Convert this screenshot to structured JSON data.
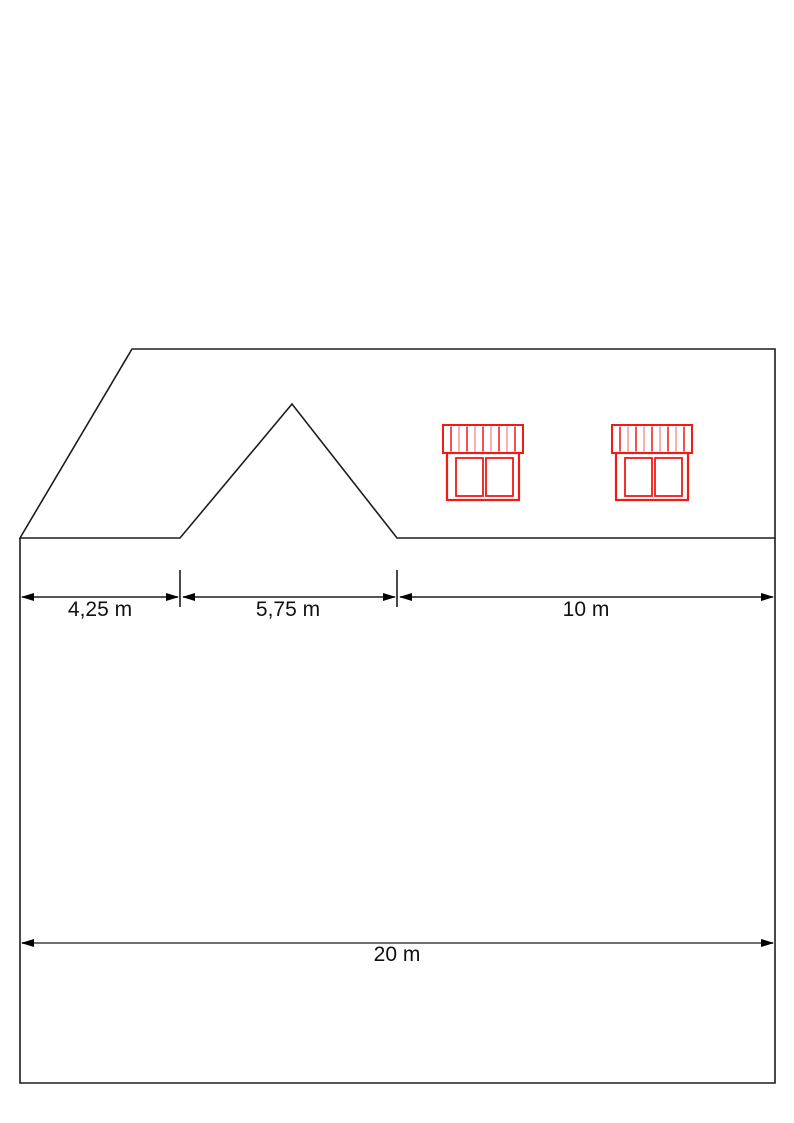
{
  "drawing": {
    "kind": "roof-elevation-technical-drawing",
    "colors": {
      "outline": "#1d1d1d",
      "hatch_dark": "#2e2e2e",
      "hatch_light": "#a9a9a9",
      "window_red": "#ee1b17",
      "window_red_light": "#f99590",
      "dim_line_gray": "#707070",
      "text": "#111111",
      "background": "#ffffff"
    }
  },
  "dimensions": {
    "d1": {
      "label": "4,25 m",
      "value_m": 4.25
    },
    "d2": {
      "label": "5,75 m",
      "value_m": 5.75
    },
    "d3": {
      "label": "10 m",
      "value_m": 10
    },
    "d4": {
      "label": "20 m",
      "value_m": 20
    }
  }
}
